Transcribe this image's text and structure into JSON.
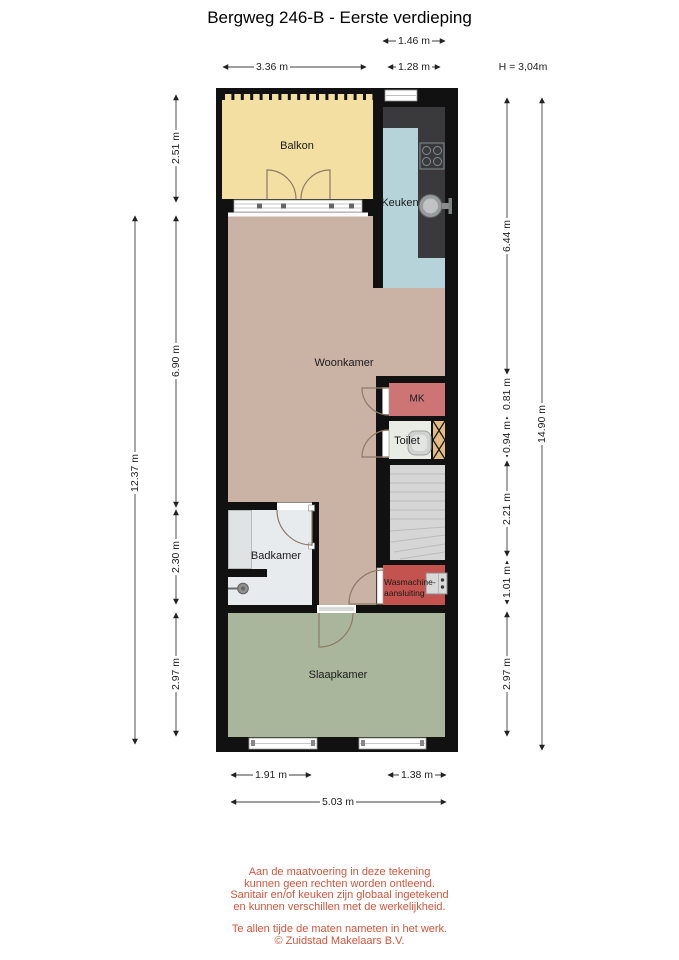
{
  "title": "Bergweg 246-B - Eerste verdieping",
  "dimensions": {
    "top": [
      "1.46 m",
      "3.36 m",
      "1.28 m"
    ],
    "height_note": "H = 3,04m",
    "left": [
      "2.51 m",
      "6.90 m",
      "2.30 m",
      "2.97 m",
      "12.37 m"
    ],
    "right": [
      "6.44 m",
      "0.81 m",
      "0.94 m",
      "2.21 m",
      "1.01 m",
      "2.97 m",
      "14.90 m"
    ],
    "bottom": [
      "1.91 m",
      "1.38 m",
      "5.03 m"
    ]
  },
  "rooms": {
    "balkon": "Balkon",
    "keuken": "Keuken",
    "woonkamer": "Woonkamer",
    "mk": "MK",
    "toilet": "Toilet",
    "badkamer": "Badkamer",
    "wasmachine_line1": "Wasmachine-",
    "wasmachine_line2": "aansluiting",
    "slaapkamer": "Slaapkamer"
  },
  "footer": {
    "disclaimer": [
      "Aan de maatvoering in deze tekening",
      "kunnen geen rechten worden ontleend.",
      "Sanitair en/of keuken zijn globaal ingetekend",
      "en kunnen verschillen met de werkelijkheid."
    ],
    "note": "Te allen tijde de maten nameten in het werk.",
    "copyright": "© Zuidstad Makelaars B.V."
  },
  "colors": {
    "wall": "#111111",
    "balkon": "#f3dfa2",
    "keuken_floor": "#b6d3d9",
    "counter": "#3a3a3c",
    "woonkamer": "#cab2a4",
    "mk": "#cd7475",
    "toilet_floor": "#e9ece4",
    "shaft": "#e3bd82",
    "stairs": "#d6d6d6",
    "wasmachine": "#c4524e",
    "badkamer": "#e8ebee",
    "slaapkamer": "#a9b69b",
    "footer_text": "#d0563c"
  }
}
